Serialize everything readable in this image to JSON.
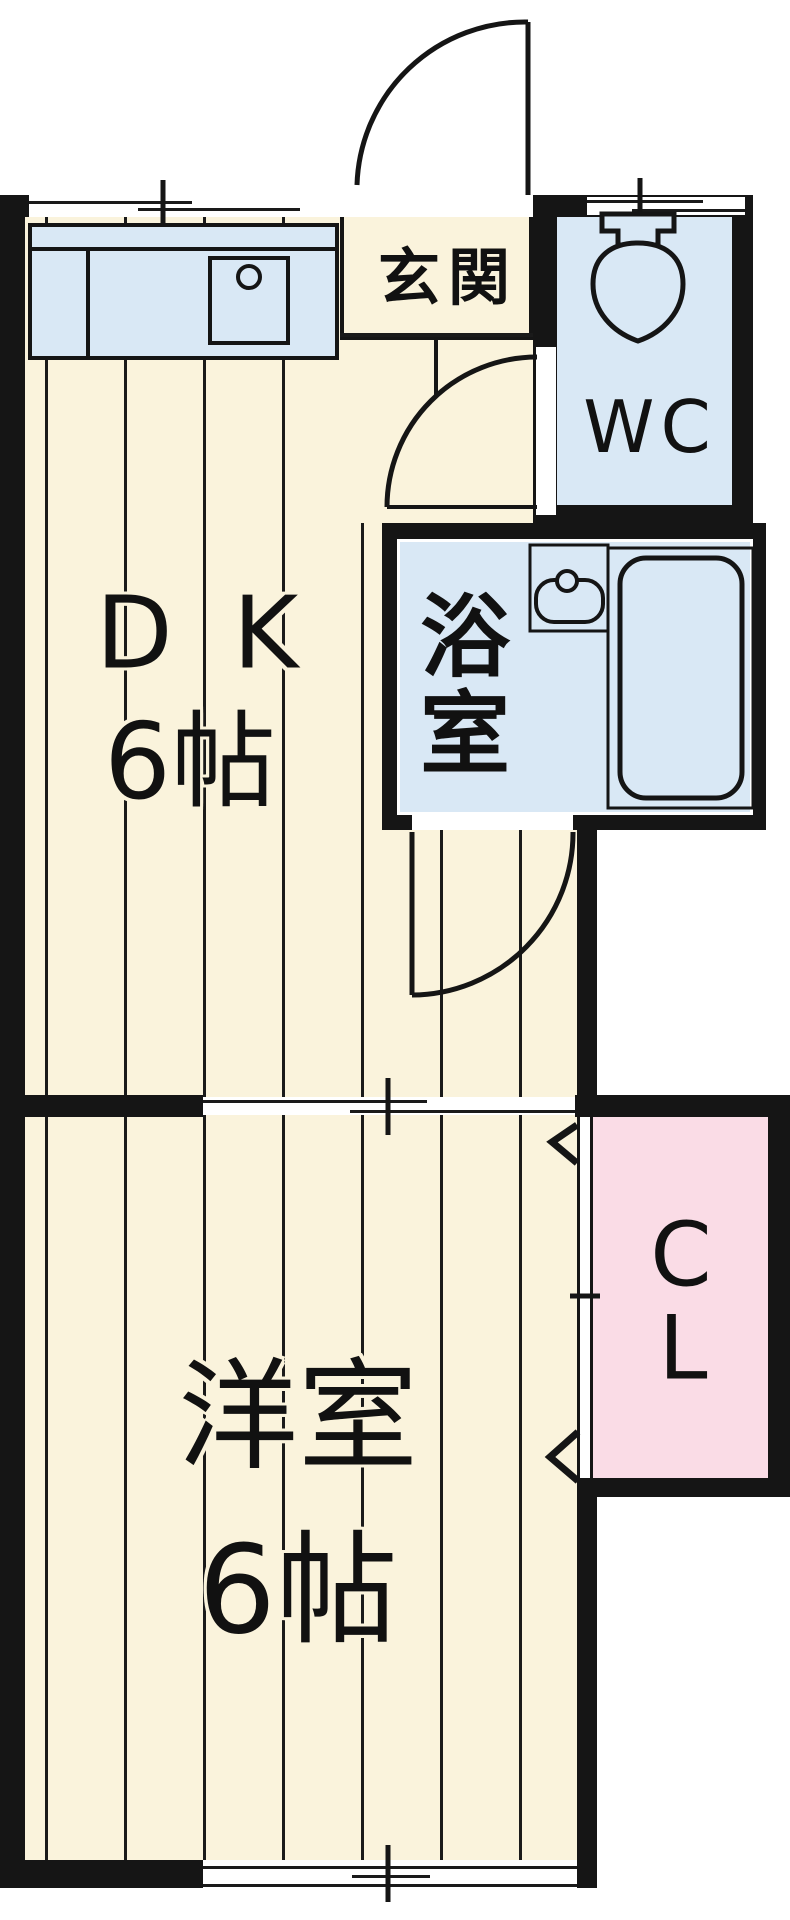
{
  "title": "apartment-floorplan",
  "rooms": {
    "dk": {
      "line1": "DK",
      "line2": "6帖"
    },
    "western": {
      "line1": "洋室",
      "line2": "6帖"
    },
    "entrance": {
      "label": "玄関"
    },
    "toilet": {
      "label": "WC"
    },
    "bath": {
      "line1": "浴",
      "line2": "室"
    },
    "closet": {
      "line1": "C",
      "line2": "L"
    }
  },
  "fixtures": [
    "kitchen-counter",
    "kitchen-sink",
    "toilet",
    "wash-basin",
    "bathtub",
    "entrance-swing-door",
    "hall-swing-door",
    "bath-swing-door",
    "sliding-partition",
    "sliding-window-top",
    "sliding-window-bottom",
    "closet-folding-door"
  ],
  "colors": {
    "floor_cream": "#faf3dc",
    "water_blue": "#d9e8f5",
    "closet_pink": "#fadce6",
    "wall_black": "#151515",
    "line_black": "#1a1a1a",
    "outside_white": "#ffffff"
  }
}
